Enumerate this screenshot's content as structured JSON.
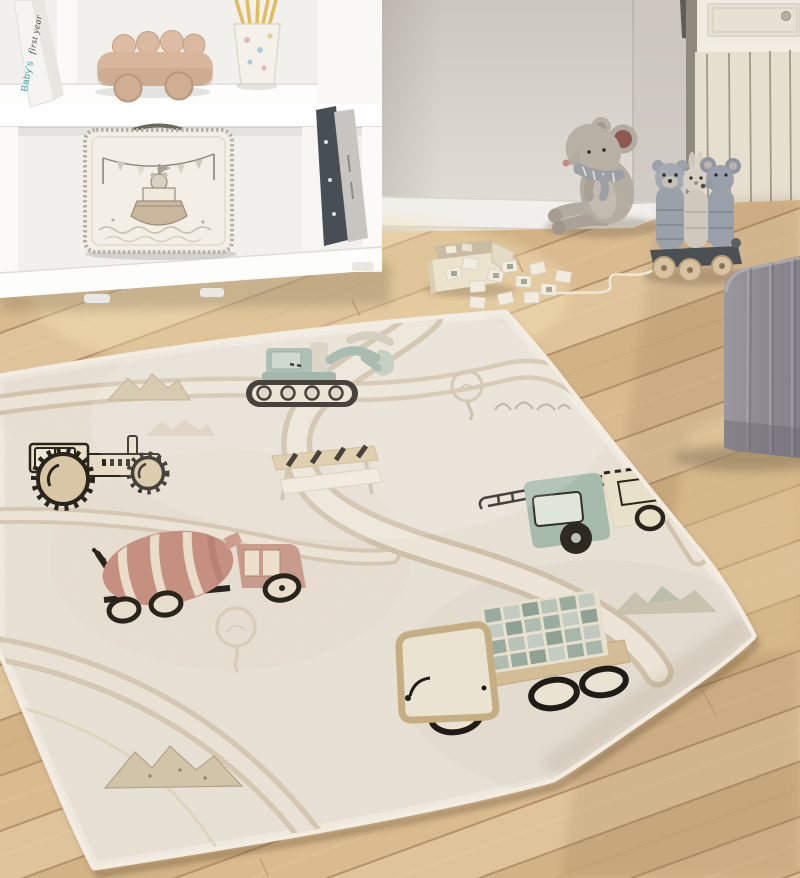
{
  "scene": {
    "name": "kids-playroom-with-vehicle-road-rug",
    "lighting": "soft daylight"
  },
  "book": {
    "part1": "Baby's",
    "part2": "first year"
  },
  "palette": {
    "wall": "#d9d3cd",
    "wall_side": "#cbc5be",
    "baseboard": "#f0efeb",
    "dresser_panel": "#e6dfd0",
    "floor_oak": "#d8ba8d",
    "floor_seam": "#b4916b",
    "shelf_white": "#f8f7f4",
    "rug_base": "#eae3d7",
    "road_edge": "#cfc1a9",
    "road_fill": "#ece5d7",
    "excavator_green": "#9cb2a6",
    "fire_truck_green": "#a7bbad",
    "mixer_terracotta": "#c59080",
    "tractor_cream": "#e8dec9",
    "dump_bed_tan": "#d3bd96",
    "load_check_sage": "#95a69b",
    "stitch_outline": "#29241c",
    "pouf_grey": "#8f8c92",
    "plush_grey": "#b5aca2",
    "wood_toy": "#d7b69c",
    "stick_yellow": "#dfbd5e"
  },
  "objects": [
    {
      "name": "white-shelf-unit"
    },
    {
      "name": "baby-book"
    },
    {
      "name": "wooden-toy-car"
    },
    {
      "name": "cup-with-sticks"
    },
    {
      "name": "toy-suitcase"
    },
    {
      "name": "binders"
    },
    {
      "name": "plush-mouse"
    },
    {
      "name": "wooden-pull-toy"
    },
    {
      "name": "memory-card-box"
    },
    {
      "name": "memory-cards"
    },
    {
      "name": "wainscot-dresser"
    },
    {
      "name": "grey-pouf"
    },
    {
      "name": "oak-floor"
    },
    {
      "name": "play-road-rug"
    },
    {
      "name": "excavator"
    },
    {
      "name": "tractor"
    },
    {
      "name": "road-barrier"
    },
    {
      "name": "cement-mixer-truck"
    },
    {
      "name": "fire-truck"
    },
    {
      "name": "dump-truck"
    },
    {
      "name": "mountain-motifs"
    },
    {
      "name": "tree-motifs"
    }
  ]
}
